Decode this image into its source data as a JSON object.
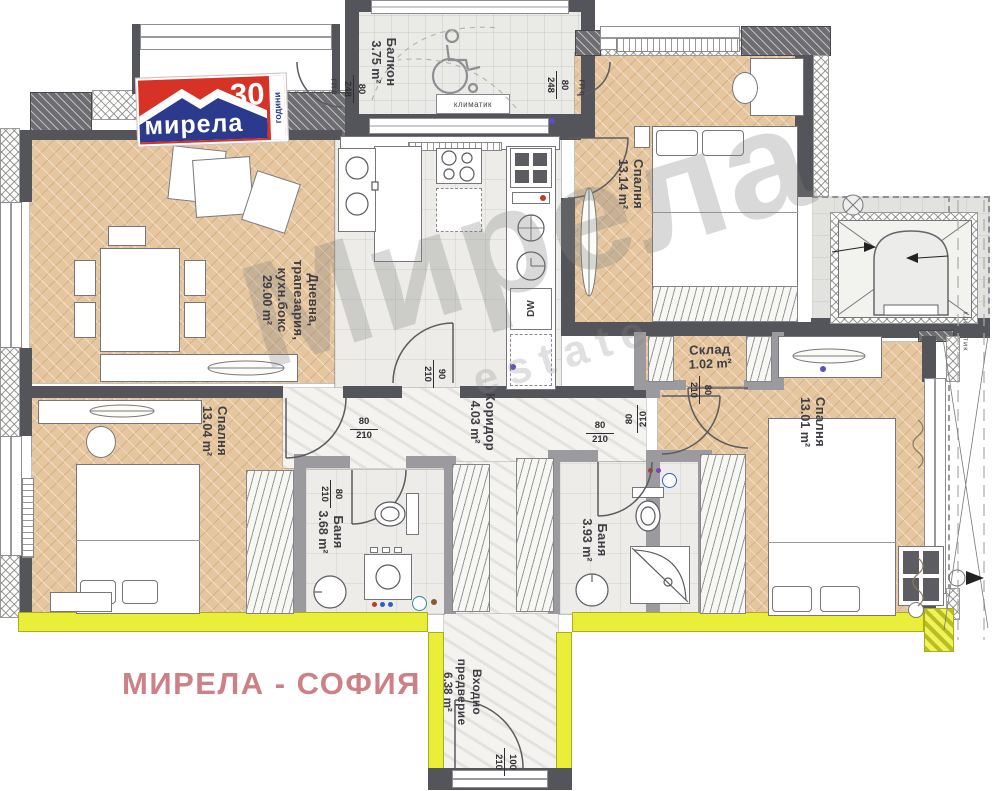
{
  "logo": {
    "brand": "мирела",
    "number": "30",
    "years": "години"
  },
  "footer": {
    "text": "МИРЕЛА - СОФИЯ"
  },
  "watermark": {
    "main": "Мирела",
    "sub": "estate"
  },
  "rooms": {
    "living": {
      "l1": "Дневна,",
      "l2": "трапезария,",
      "l3": "кухн.бокс",
      "area": "29.00 m²"
    },
    "balcony": {
      "name": "Балкон",
      "area": "3.75 m²"
    },
    "bedroom_top": {
      "name": "Спалня",
      "area": "13.14 m²"
    },
    "storage": {
      "name": "Склад",
      "area": "1.02 m²"
    },
    "corridor": {
      "name": "Коридор",
      "area": "4.03 m²"
    },
    "bedroom_left": {
      "name": "Спалня",
      "area": "13.04 m²"
    },
    "bedroom_right": {
      "name": "Спалня",
      "area": "13.01 m²"
    },
    "bath_left": {
      "name": "Баня",
      "area": "3.68 m²"
    },
    "bath_right": {
      "name": "Баня",
      "area": "3.93 m²"
    },
    "entry": {
      "l1": "Входно",
      "l2": "предверие",
      "area": "6.38 m²"
    }
  },
  "dims": {
    "balcony_left": {
      "a": "80",
      "b": "248",
      "note": "ГП 0"
    },
    "balcony_right": {
      "a": "80",
      "b": "248",
      "note": "ГП 0"
    },
    "kitchen_door": {
      "a": "90",
      "b": "210"
    },
    "bedroom_left_door": {
      "a": "80",
      "b": "210"
    },
    "bath_left_door": {
      "a": "80",
      "b": "210"
    },
    "bath_right_door": {
      "a": "80",
      "b": "210"
    },
    "bedroom_right_door": {
      "a": "80",
      "b": "210"
    },
    "storage_door": {
      "a": "80",
      "b": "210"
    },
    "entry_door": {
      "a": "100",
      "b": "210"
    }
  },
  "labels": {
    "ac_unit": "климатик",
    "ac_side": "климатик",
    "dishwasher": "DW"
  },
  "colors": {
    "accent_red": "#d63226",
    "accent_blue": "#2b3a8c",
    "wall": "#54555b",
    "yellow": "#e9ef38",
    "parquet": "#e6c69e",
    "footer_pink": "#cd8186"
  }
}
